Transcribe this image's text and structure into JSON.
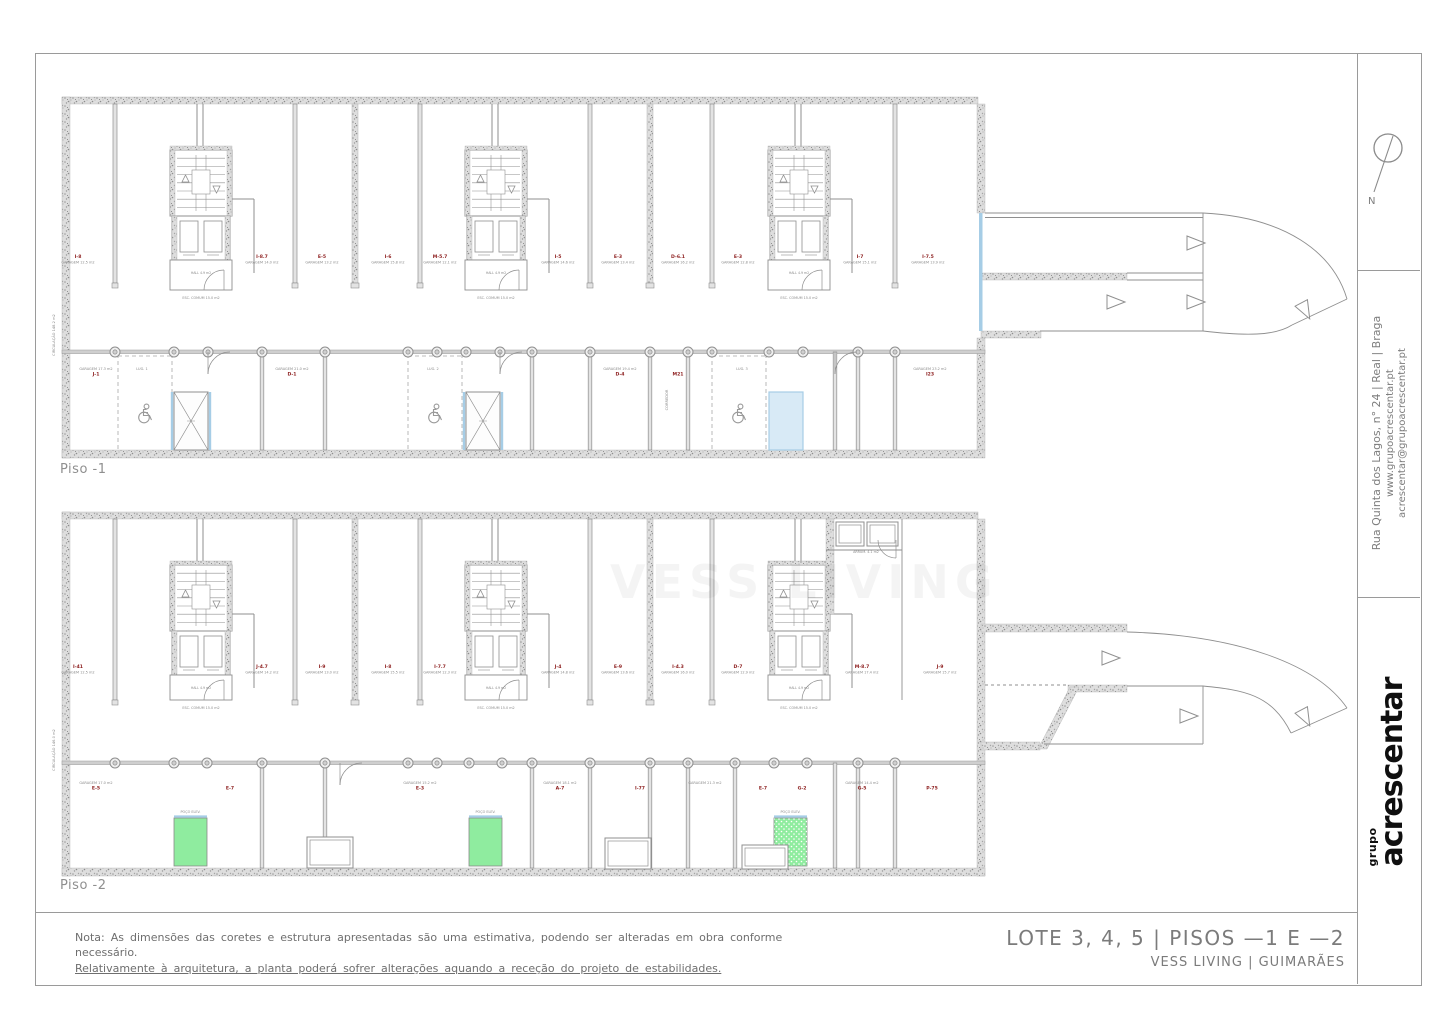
{
  "colors": {
    "line": "#8f8f8f",
    "text": "#8a8a8a",
    "red": "#8c1d1d",
    "blue": "#a6cde6",
    "blue_fill": "#d8eaf6",
    "green": "#8fec9f",
    "wall_fill": "#e3e3e3"
  },
  "sheet": {
    "piso1_label": "Piso -1",
    "piso2_label": "Piso -2",
    "north_label": "N",
    "watermark": "VESS LIVING",
    "sidebar": {
      "address_line1": "Rua Quinta dos Lagos, n° 24 | Real | Braga",
      "address_line2": "www.grupoacrescentar.pt",
      "address_line3": "acrescentar@grupoacrescentar.pt",
      "logo_top": "grupo",
      "logo_main": "acrescentar"
    },
    "titleblock": {
      "title": "LOTE 3, 4, 5 | PISOS —1 E —2",
      "subtitle": "VESS LIVING | GUIMARÃES"
    },
    "note": {
      "line1": "Nota: As dimensões das coretes e estrutura apresentadas são uma estimativa, podendo ser alteradas em obra conforme",
      "line2": "necessário.",
      "line3": "Relativamente à arquitetura, a planta poderá sofrer alterações aquando a receção do projeto de estabilidades."
    }
  },
  "plans": [
    {
      "name": "Piso -1",
      "label_pos": [
        60,
        462
      ],
      "walls": {
        "top": [
          62,
          97,
          916,
          7
        ],
        "left": [
          62,
          97,
          8,
          361
        ],
        "right": [
          [
            977,
            104,
            8,
            109
          ],
          [
            977,
            338,
            8,
            112
          ]
        ],
        "bottom": [
          62,
          450,
          923,
          8
        ]
      },
      "band1": {
        "y0": 104,
        "y1": 283,
        "partitions": [
          115,
          295,
          420,
          590,
          712,
          895
        ],
        "thick": [
          355,
          650
        ],
        "label_y": 258,
        "labels": [
          [
            78,
            "I-8",
            "GARAGEM 12.5 m2"
          ],
          [
            262,
            "I-8.7",
            "GARAGEM 14.0 m2"
          ],
          [
            322,
            "E-5",
            "GARAGEM 13.2 m2"
          ],
          [
            388,
            "I-6",
            "GARAGEM 15.8 m2"
          ],
          [
            440,
            "M-5.7",
            "GARAGEM 12.1 m2"
          ],
          [
            558,
            "I-5",
            "GARAGEM 14.6 m2"
          ],
          [
            618,
            "E-3",
            "GARAGEM 13.4 m2"
          ],
          [
            678,
            "D-6.1",
            "GARAGEM 16.2 m2"
          ],
          [
            738,
            "E-3",
            "GARAGEM 12.8 m2"
          ],
          [
            860,
            "I-7",
            "GARAGEM 15.1 m2"
          ],
          [
            928,
            "I-7.5",
            "GARAGEM 13.9 m2"
          ]
        ]
      },
      "cores": {
        "x": [
          170,
          465,
          768
        ],
        "top": 150,
        "stair_h": 66,
        "elev_h": 44,
        "lobby_h": 30,
        "hall_text": "HALL 4.9 m2",
        "caption": "ESC. COMUM 15.0 m2"
      },
      "band2": {
        "top": 352,
        "bot": 450,
        "solid": [
          262,
          325,
          532,
          590,
          650,
          688,
          835,
          858,
          895
        ],
        "stalls": [
          [
            118,
            172
          ],
          [
            408,
            462
          ],
          [
            712,
            766
          ]
        ],
        "wheelchairs": [
          145,
          435,
          739
        ],
        "wc_y": 415,
        "shaft_y": [
          392,
          450
        ],
        "shafts": [
          {
            "x": 174,
            "w": 34,
            "kind": "x"
          },
          {
            "x": 466,
            "w": 34,
            "kind": "x"
          },
          {
            "x": 769,
            "w": 34,
            "kind": "blue"
          }
        ],
        "columns": [
          115,
          174,
          208,
          262,
          325,
          408,
          437,
          466,
          500,
          532,
          590,
          650,
          688,
          712,
          769,
          803,
          858,
          895
        ],
        "arcs": [
          [
            208,
            352
          ],
          [
            500,
            352
          ],
          [
            835,
            352
          ]
        ],
        "boxes": [],
        "shaft_label": "",
        "label_y": 370,
        "labels": [
          [
            96,
            "J-1",
            "GARAGEM 17.3 m2"
          ],
          [
            142,
            "",
            "LUG. 1"
          ],
          [
            292,
            "D-1",
            "GARAGEM 21.0 m2"
          ],
          [
            433,
            "",
            "LUG. 2"
          ],
          [
            620,
            "D-4",
            "GARAGEM 19.4 m2"
          ],
          [
            678,
            "M21",
            ""
          ],
          [
            742,
            "",
            "LUG. 3"
          ],
          [
            930,
            "I23",
            "GARAGEM 23.2 m2"
          ]
        ]
      },
      "vtexts": [
        [
          55,
          335,
          "CIRCULAÇÃO 148.2 m2"
        ],
        [
          668,
          400,
          "CORREDOR"
        ]
      ],
      "extras": null,
      "ramp": {
        "specks": [
          [
            981,
            273,
            146,
            7
          ],
          [
            981,
            331,
            60,
            7
          ]
        ],
        "blue": [
          [
            979,
            213,
            3.5,
            118
          ]
        ],
        "polys": [],
        "lines": [
          [
            985,
            213,
            1203,
            213,
            ""
          ],
          [
            985,
            217.5,
            1203,
            217.5,
            ""
          ],
          [
            1127,
            273,
            1203,
            273,
            ""
          ],
          [
            1127,
            280,
            1203,
            280,
            ""
          ],
          [
            1040,
            331,
            1203,
            331,
            ""
          ],
          [
            1203,
            213,
            1203,
            331,
            ""
          ]
        ],
        "paths": [
          "M1203,213 C1285,217 1333,252 1347,299",
          "M1203,331 C1245,336 1275,336 1292,325",
          "M1347,299 L1292,325"
        ],
        "arrows": [
          [
            1195,
            243,
            0
          ],
          [
            1115,
            302,
            0
          ],
          [
            1195,
            302,
            0
          ],
          [
            1305,
            310,
            62
          ]
        ]
      }
    },
    {
      "name": "Piso -2",
      "label_pos": [
        60,
        878
      ],
      "walls": {
        "top": [
          62,
          512,
          916,
          7
        ],
        "left": [
          62,
          512,
          8,
          364
        ],
        "right": [
          [
            977,
            519,
            8,
            357
          ]
        ],
        "bottom": [
          62,
          868,
          923,
          8
        ]
      },
      "band1": {
        "y0": 519,
        "y1": 700,
        "partitions": [
          115,
          295,
          420,
          590,
          712
        ],
        "thick": [
          355,
          650
        ],
        "label_y": 668,
        "labels": [
          [
            78,
            "I-41",
            "GARAGEM 12.5 m2"
          ],
          [
            262,
            "J-4.7",
            "GARAGEM 14.2 m2"
          ],
          [
            322,
            "I-9",
            "GARAGEM 13.0 m2"
          ],
          [
            388,
            "I-8",
            "GARAGEM 15.5 m2"
          ],
          [
            440,
            "I-7.7",
            "GARAGEM 12.3 m2"
          ],
          [
            558,
            "J-4",
            "GARAGEM 14.8 m2"
          ],
          [
            618,
            "E-9",
            "GARAGEM 13.6 m2"
          ],
          [
            678,
            "I-4.3",
            "GARAGEM 16.0 m2"
          ],
          [
            738,
            "D-7",
            "GARAGEM 12.9 m2"
          ],
          [
            862,
            "M-8.7",
            "GARAGEM 17.4 m2"
          ],
          [
            940,
            "J-9",
            "GARAGEM 15.7 m2"
          ]
        ]
      },
      "cores": {
        "x": [
          170,
          465,
          768
        ],
        "top": 565,
        "stair_h": 66,
        "elev_h": 44,
        "lobby_h": 25,
        "hall_text": "HALL 4.9 m2",
        "caption": "ESC. COMUM 15.0 m2"
      },
      "band2": {
        "top": 763,
        "bot": 868,
        "solid": [
          262,
          325,
          532,
          590,
          650,
          688,
          735,
          835,
          858,
          895
        ],
        "stalls": [],
        "wheelchairs": [],
        "wc_y": 0,
        "shaft_y": [
          818,
          866
        ],
        "shafts": [
          {
            "x": 174,
            "w": 33,
            "kind": "green"
          },
          {
            "x": 469,
            "w": 33,
            "kind": "green"
          },
          {
            "x": 774,
            "w": 33,
            "kind": "greendots"
          }
        ],
        "columns": [
          115,
          174,
          207,
          262,
          325,
          408,
          437,
          469,
          502,
          532,
          590,
          650,
          688,
          735,
          774,
          807,
          858,
          895
        ],
        "arcs": [
          [
            340,
            763
          ]
        ],
        "boxes": [
          [
            307,
            837,
            46,
            31
          ],
          [
            605,
            838,
            46,
            31
          ],
          [
            742,
            845,
            46,
            24
          ]
        ],
        "shaft_label": "POÇO ELEV.",
        "label_y": 784,
        "labels": [
          [
            96,
            "E-5",
            "GARAGEM 17.0 m2"
          ],
          [
            230,
            "E-7",
            ""
          ],
          [
            420,
            "E-3",
            "GARAGEM 15.2 m2"
          ],
          [
            560,
            "A-7",
            "GARAGEM 18.1 m2"
          ],
          [
            640,
            "I-77",
            ""
          ],
          [
            705,
            "",
            "GARAGEM 21.3 m2"
          ],
          [
            763,
            "E-7",
            ""
          ],
          [
            802,
            "G-2",
            ""
          ],
          [
            862,
            "G-5",
            "GARAGEM 14.4 m2"
          ],
          [
            932,
            "P-75",
            ""
          ]
        ]
      },
      "vtexts": [
        [
          55,
          750,
          "CIRCULAÇÃO 146.0 m2"
        ]
      ],
      "extras": {
        "vwall": [
          826,
          519,
          8,
          95
        ],
        "boxes": [
          [
            836,
            522,
            28,
            24
          ],
          [
            867,
            522,
            31,
            24
          ]
        ],
        "box_label": [
          866,
          553,
          "ARRUM. 4.1 m2"
        ],
        "lines": [
          [
            826,
            550,
            902,
            550
          ],
          [
            902,
            519,
            902,
            700
          ]
        ],
        "arc": [
          896,
          540
        ]
      },
      "ramp": {
        "specks": [
          [
            981,
            624,
            146,
            8
          ],
          [
            1068,
            685,
            59,
            7
          ],
          [
            981,
            742,
            59,
            8
          ]
        ],
        "blue": [],
        "polys": [
          [
            1070,
            687,
            1079,
            687,
            1047,
            749,
            1038,
            749
          ]
        ],
        "lines": [
          [
            985,
            685,
            1068,
            685,
            "3 3"
          ],
          [
            1127,
            686,
            1203,
            686,
            ""
          ],
          [
            1044,
            744,
            1203,
            744,
            ""
          ],
          [
            1203,
            686,
            1203,
            744,
            ""
          ]
        ],
        "paths": [
          "M1127,632 C1235,635 1316,663 1347,708",
          "M1203,686 C1243,690 1272,694 1291,733",
          "M1347,708 L1291,733"
        ],
        "arrows": [
          [
            1110,
            658,
            0
          ],
          [
            1188,
            716,
            0
          ],
          [
            1305,
            717,
            62
          ]
        ]
      }
    }
  ]
}
